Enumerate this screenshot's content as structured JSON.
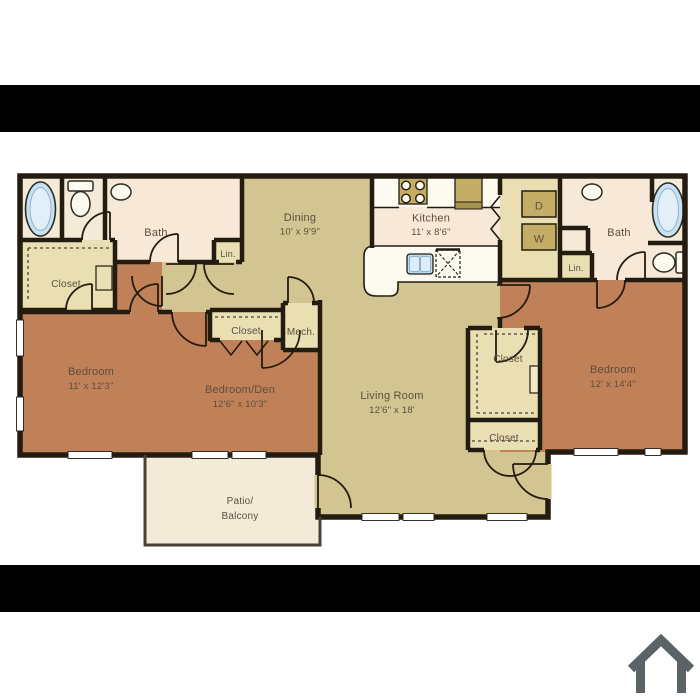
{
  "plan": {
    "bath_left": "Bath",
    "lin_left": "Lin.",
    "closet_left": "Closet",
    "dining_name": "Dining",
    "dining_dims": "10' x 9'9\"",
    "kitchen_name": "Kitchen",
    "kitchen_dims": "11' x 8'6\"",
    "dryer": "D",
    "washer": "W",
    "bath_right": "Bath",
    "lin_right": "Lin.",
    "bedroom_left_name": "Bedroom",
    "bedroom_left_dims": "11' x 12'3\"",
    "bedroom_den_name": "Bedroom/Den",
    "bedroom_den_dims": "12'6\" x 10'3\"",
    "closet_mid": "Closet",
    "mech": "Mech.",
    "living_name": "Living Room",
    "living_dims": "12'6\" x 18'",
    "closet_walkin": "Closet",
    "closet_lower": "Closet",
    "bedroom_right_name": "Bedroom",
    "bedroom_right_dims": "12' x 14'4\"",
    "patio_line1": "Patio/",
    "patio_line2": "Balcony"
  },
  "colors": {
    "wall": "#241c11",
    "floor_living": "#d3c591",
    "floor_bedroom": "#c08158",
    "floor_bath": "#f8e8d8",
    "floor_closet": "#e9dfb2",
    "floor_cream": "#f3ead7",
    "floor_patio": "#f4ead8",
    "appliance_tan": "#c4ae66",
    "appliance_dark": "#a6914d",
    "fixture_blue": "#c9e0f0",
    "fixture_white": "#fdfaef",
    "letterbox": "#000000",
    "text": "#5e4e3d",
    "home_icon": "#5c6367"
  },
  "icons": {
    "home": "home-icon"
  }
}
